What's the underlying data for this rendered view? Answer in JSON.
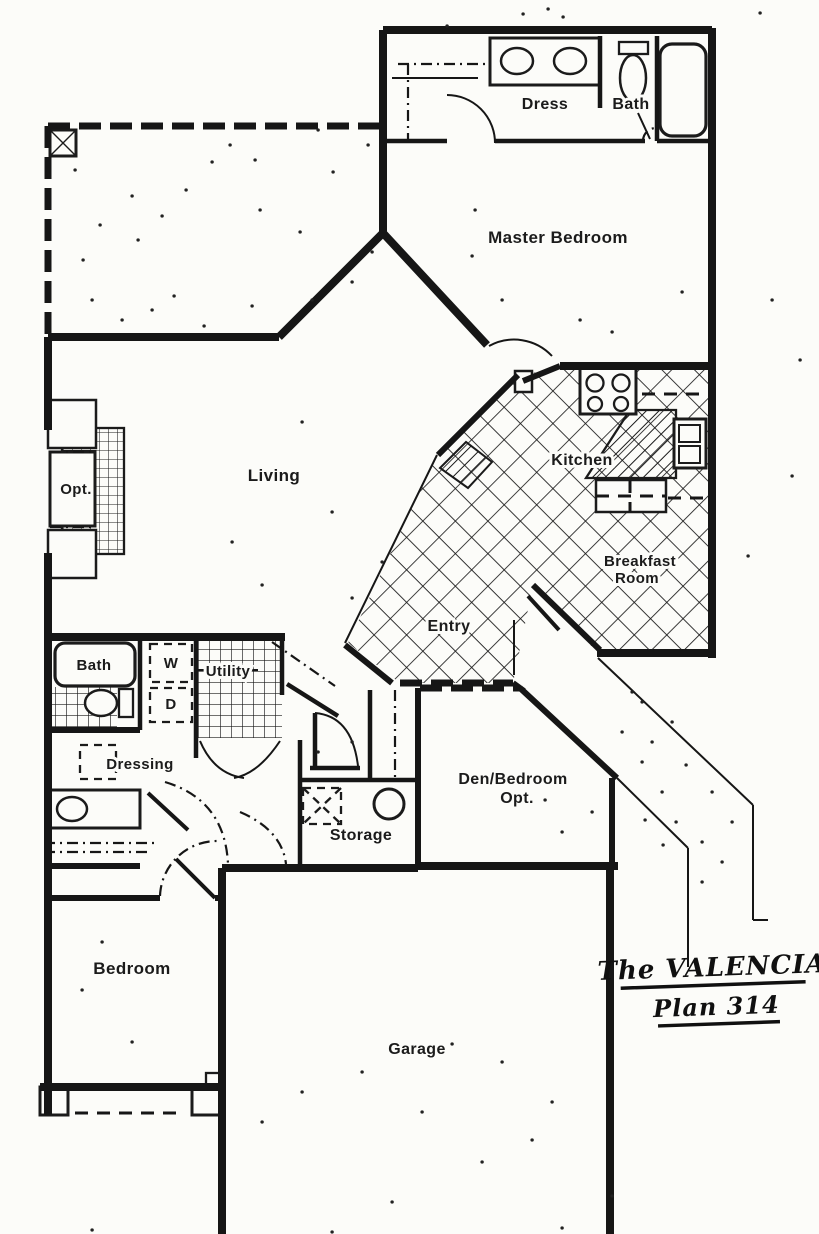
{
  "title": {
    "line1": "The VALENCIA",
    "line2": "Plan 314"
  },
  "rooms": {
    "dress": "Dress",
    "bath_upper": "Bath",
    "master_bedroom": "Master Bedroom",
    "living": "Living",
    "fireplace_opt": "Opt.",
    "kitchen": "Kitchen",
    "breakfast_line1": "Breakfast",
    "breakfast_line2": "Room",
    "entry": "Entry",
    "bath_lower": "Bath",
    "washer": "W",
    "dryer": "D",
    "utility": "Utility",
    "dressing": "Dressing",
    "den_line1": "Den/Bedroom",
    "den_line2": "Opt.",
    "storage": "Storage",
    "bedroom": "Bedroom",
    "garage": "Garage"
  },
  "colors": {
    "ink": "#1b1b1b",
    "paper": "#fcfcf9"
  }
}
